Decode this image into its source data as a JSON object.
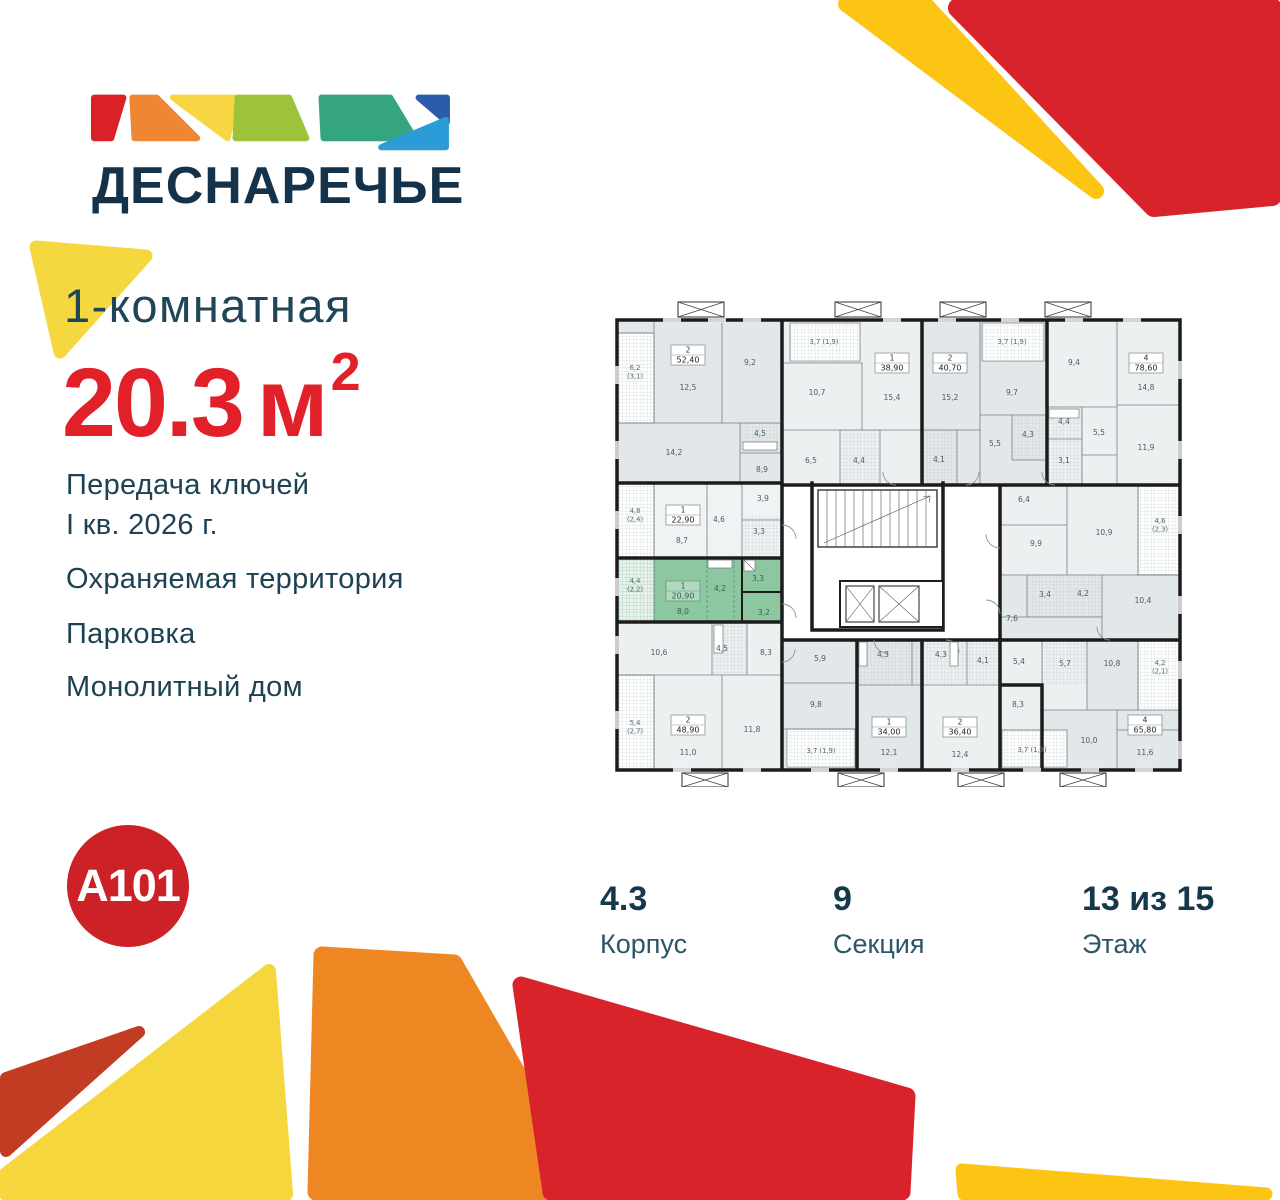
{
  "logo": {
    "name": "ДЕСНАРЕЧЬЕ"
  },
  "headline": {
    "rooms_label": "1-комнатная",
    "area_value": "20.3",
    "area_unit": "м",
    "area_sup": "2"
  },
  "features": {
    "handover_line1": "Передача ключей",
    "handover_line2": "I кв. 2026 г.",
    "items": [
      "Охраняемая территория",
      "Парковка",
      "Монолитный дом"
    ]
  },
  "developer": {
    "label": "A101"
  },
  "footer": {
    "columns": [
      {
        "value": "4.3",
        "label": "Корпус"
      },
      {
        "value": "9",
        "label": "Секция"
      },
      {
        "value": "13 из 15",
        "label": "Этаж"
      }
    ]
  },
  "colors": {
    "accent_red": "#e2202a",
    "navy": "#1d4254",
    "highlight_green": "#8cc7a0",
    "decor_yellow": "#f5d840",
    "decor_gold": "#fcc413",
    "decor_orange": "#ee8722",
    "decor_red": "#d8232a",
    "decor_dark_red": "#c23b23",
    "developer_red": "#cb2127"
  },
  "floorplan": {
    "highlighted_unit": {
      "type": "1",
      "area": "20,90"
    },
    "apartments": [
      {
        "type": "2",
        "area": "52,40",
        "x": 76,
        "y": 40
      },
      {
        "type": "1",
        "area": "38,90",
        "x": 280,
        "y": 48
      },
      {
        "type": "2",
        "area": "40,70",
        "x": 338,
        "y": 48
      },
      {
        "type": "4",
        "area": "78,60",
        "x": 534,
        "y": 48
      },
      {
        "type": "1",
        "area": "22,90",
        "x": 71,
        "y": 200
      },
      {
        "type": "1",
        "area": "20,90",
        "x": 71,
        "y": 276,
        "green": true
      },
      {
        "type": "2",
        "area": "48,90",
        "x": 76,
        "y": 410
      },
      {
        "type": "1",
        "area": "34,00",
        "x": 277,
        "y": 412
      },
      {
        "type": "2",
        "area": "36,40",
        "x": 348,
        "y": 412
      },
      {
        "type": "4",
        "area": "65,80",
        "x": 533,
        "y": 410
      }
    ],
    "rooms": [
      {
        "t": "6,2\n(3,1)",
        "x": 23,
        "y": 55,
        "c": "b"
      },
      {
        "t": "12,5",
        "x": 76,
        "y": 75
      },
      {
        "t": "9,2",
        "x": 138,
        "y": 50
      },
      {
        "t": "4,5",
        "x": 148,
        "y": 121
      },
      {
        "t": "14,2",
        "x": 62,
        "y": 140
      },
      {
        "t": "8,9",
        "x": 150,
        "y": 157
      },
      {
        "t": "3,7 (1,9)",
        "x": 212,
        "y": 29,
        "c": "b"
      },
      {
        "t": "10,7",
        "x": 205,
        "y": 80
      },
      {
        "t": "15,4",
        "x": 280,
        "y": 85
      },
      {
        "t": "6,5",
        "x": 199,
        "y": 148
      },
      {
        "t": "4,4",
        "x": 247,
        "y": 148
      },
      {
        "t": "15,2",
        "x": 338,
        "y": 85
      },
      {
        "t": "3,7 (1,9)",
        "x": 400,
        "y": 29,
        "c": "b"
      },
      {
        "t": "9,7",
        "x": 400,
        "y": 80
      },
      {
        "t": "5,5",
        "x": 383,
        "y": 131
      },
      {
        "t": "4,3",
        "x": 416,
        "y": 122
      },
      {
        "t": "4,1",
        "x": 327,
        "y": 147
      },
      {
        "t": "9,4",
        "x": 462,
        "y": 50
      },
      {
        "t": "14,8",
        "x": 534,
        "y": 75
      },
      {
        "t": "4,4",
        "x": 452,
        "y": 109
      },
      {
        "t": "5,5",
        "x": 487,
        "y": 120
      },
      {
        "t": "3,1",
        "x": 452,
        "y": 148
      },
      {
        "t": "11,9",
        "x": 534,
        "y": 135
      },
      {
        "t": "4,8\n(2,4)",
        "x": 23,
        "y": 198,
        "c": "b"
      },
      {
        "t": "8,7",
        "x": 70,
        "y": 228
      },
      {
        "t": "4,6",
        "x": 107,
        "y": 207
      },
      {
        "t": "3,9",
        "x": 151,
        "y": 186
      },
      {
        "t": "3,3",
        "x": 147,
        "y": 219
      },
      {
        "t": "4,4\n(2,2)",
        "x": 23,
        "y": 268,
        "c": "gb"
      },
      {
        "t": "4,2",
        "x": 108,
        "y": 276,
        "c": "g"
      },
      {
        "t": "3,3",
        "x": 146,
        "y": 266,
        "c": "g"
      },
      {
        "t": "8,0",
        "x": 71,
        "y": 299,
        "c": "g"
      },
      {
        "t": "3,2",
        "x": 152,
        "y": 300,
        "c": "g"
      },
      {
        "t": "10,6",
        "x": 47,
        "y": 340
      },
      {
        "t": "4,5",
        "x": 110,
        "y": 336
      },
      {
        "t": "8,3",
        "x": 154,
        "y": 340
      },
      {
        "t": "5,4\n(2,7)",
        "x": 23,
        "y": 410,
        "c": "b"
      },
      {
        "t": "11,0",
        "x": 76,
        "y": 440
      },
      {
        "t": "11,8",
        "x": 140,
        "y": 417
      },
      {
        "t": "5,9",
        "x": 208,
        "y": 346
      },
      {
        "t": "9,8",
        "x": 204,
        "y": 392
      },
      {
        "t": "3,7 (1,9)",
        "x": 209,
        "y": 438,
        "c": "b"
      },
      {
        "t": "4,3",
        "x": 271,
        "y": 342
      },
      {
        "t": "4,3",
        "x": 329,
        "y": 342
      },
      {
        "t": "4,1",
        "x": 371,
        "y": 348
      },
      {
        "t": "12,1",
        "x": 277,
        "y": 440
      },
      {
        "t": "12,4",
        "x": 348,
        "y": 442
      },
      {
        "t": "6,4",
        "x": 412,
        "y": 187
      },
      {
        "t": "9,9",
        "x": 424,
        "y": 231
      },
      {
        "t": "10,9",
        "x": 492,
        "y": 220
      },
      {
        "t": "4,6\n(2,3)",
        "x": 548,
        "y": 208,
        "c": "b"
      },
      {
        "t": "3,4",
        "x": 433,
        "y": 282
      },
      {
        "t": "4,2",
        "x": 471,
        "y": 281
      },
      {
        "t": "7,6",
        "x": 400,
        "y": 306
      },
      {
        "t": "10,4",
        "x": 531,
        "y": 288
      },
      {
        "t": "5,4",
        "x": 407,
        "y": 349
      },
      {
        "t": "5,7",
        "x": 453,
        "y": 351
      },
      {
        "t": "8,3",
        "x": 406,
        "y": 392
      },
      {
        "t": "10,8",
        "x": 500,
        "y": 351
      },
      {
        "t": "4,2\n(2,1)",
        "x": 548,
        "y": 350,
        "c": "b"
      },
      {
        "t": "3,7 (1,9)",
        "x": 420,
        "y": 437,
        "c": "b"
      },
      {
        "t": "10,0",
        "x": 477,
        "y": 428
      },
      {
        "t": "11,6",
        "x": 533,
        "y": 440
      }
    ]
  }
}
